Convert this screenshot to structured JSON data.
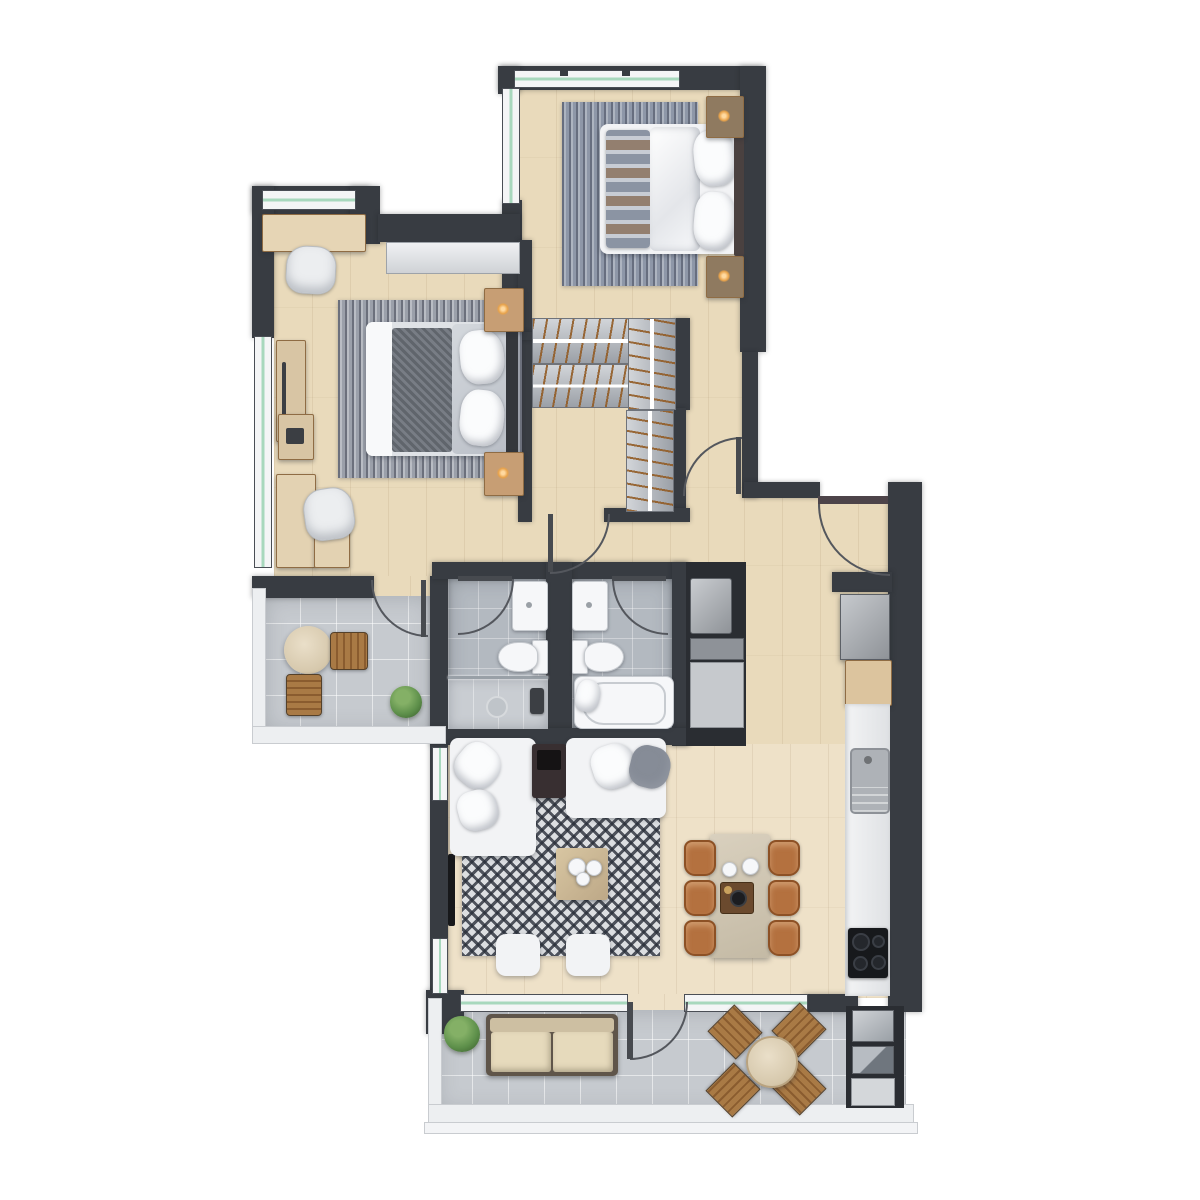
{
  "scene": {
    "type": "apartment-floor-plan-render",
    "view": "top-down-3d",
    "canvas": {
      "width": 1200,
      "height": 1200
    },
    "visible_text": ""
  },
  "palette": {
    "wall": "#383c42",
    "wall_dark": "#2a2d32",
    "wood": "#e9dabb",
    "wood_light": "#eee1c8",
    "tile": "#c6cacf",
    "bath_tile": "#b3b9c0",
    "glass": "#a8d8bd",
    "white": "#f2f3f5",
    "railing": "#edeff1",
    "rug_blue": "#8e97a8",
    "rug_gray": "#9ba0aa",
    "chevron_light": "#dcdee1",
    "wood_furniture": "#c8a57e",
    "leather": "#b4713f",
    "beige": "#d6c8ac",
    "dark_console": "#382f31",
    "cooktop": "#17191c",
    "plant": "#5d8f4a",
    "lamp": "#e8a24a",
    "pillow_gray": "#868c97"
  },
  "rooms": {
    "master_bedroom": {
      "furniture": [
        "double bed with striped runner",
        "area rug",
        "2 nightstands",
        "2 lit table lamps",
        "corner windows"
      ]
    },
    "bedroom_2": {
      "furniture": [
        "double bed",
        "area rug",
        "2 nightstands with lamps",
        "built-in white wardrobe",
        "dresser",
        "desk with chair",
        "corner desk with chair",
        "window wall"
      ]
    },
    "wardrobe_hall": {
      "furniture": [
        "2 horizontal wardrobe units with hangers",
        "2 vertical wardrobe units with hangers"
      ]
    },
    "bathroom_1": {
      "furniture": [
        "walk-in shower",
        "toilet",
        "washbasin"
      ]
    },
    "bathroom_2": {
      "furniture": [
        "bathtub",
        "toilet",
        "washbasin"
      ]
    },
    "utility_closet": {
      "furniture": [
        "washing machine",
        "shelf",
        "cabinet front"
      ]
    },
    "kitchen": {
      "furniture": [
        "refrigerator",
        "wood counter",
        "white counter run",
        "sink with drainboard",
        "4-burner cooktop"
      ]
    },
    "living_dining": {
      "furniture": [
        "chaise sofa",
        "two-seat sofa",
        "dark console",
        "chevron rug",
        "coffee table with plates",
        "2 ottomans",
        "wall TV",
        "dining table",
        "6 leather chairs",
        "centerpiece tray"
      ]
    },
    "balcony_left": {
      "furniture": [
        "round bistro table",
        "2 wooden chairs",
        "potted plant"
      ]
    },
    "terrace_bottom": {
      "furniture": [
        "outdoor sofa",
        "round dining table",
        "4 wooden chairs",
        "potted plant",
        "storage/AC module"
      ]
    }
  },
  "counts": {
    "bedrooms": 2,
    "bathrooms": 2,
    "balconies": 2,
    "door_swings": 7,
    "dining_chairs": 6,
    "terrace_chairs": 4
  }
}
